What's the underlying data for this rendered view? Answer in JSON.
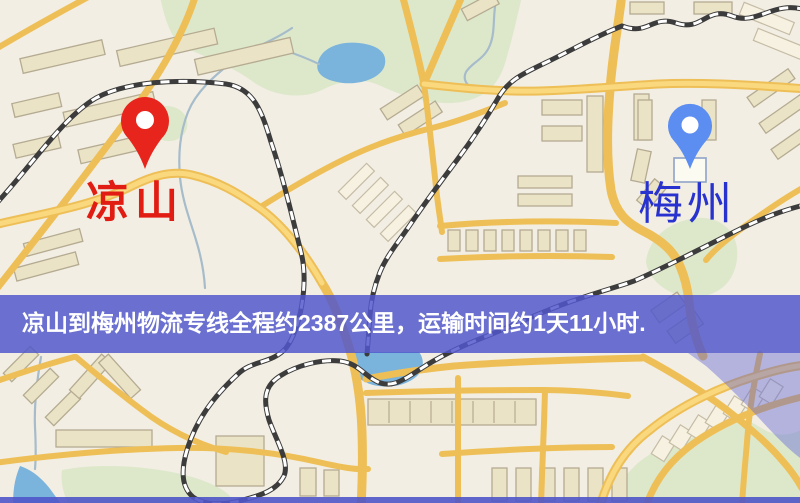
{
  "map": {
    "banner": {
      "text": "凉山到梅州物流专线全程约2387公里，运输时间约1天11小时.",
      "background_color": "#5157cc",
      "text_color": "#ffffff"
    },
    "origin_pin": {
      "label": "凉山",
      "label_color": "#e11c12",
      "pin_color": "#e8251d"
    },
    "destination_pin": {
      "label": "梅州",
      "label_color": "#2832cf",
      "pin_color": "#5c8df0"
    },
    "palette": {
      "background": "#f2eee3",
      "park": "#dde8cb",
      "water": "#7ab3dc",
      "road": "#eebf57",
      "railway": "#3c3c3c"
    }
  }
}
